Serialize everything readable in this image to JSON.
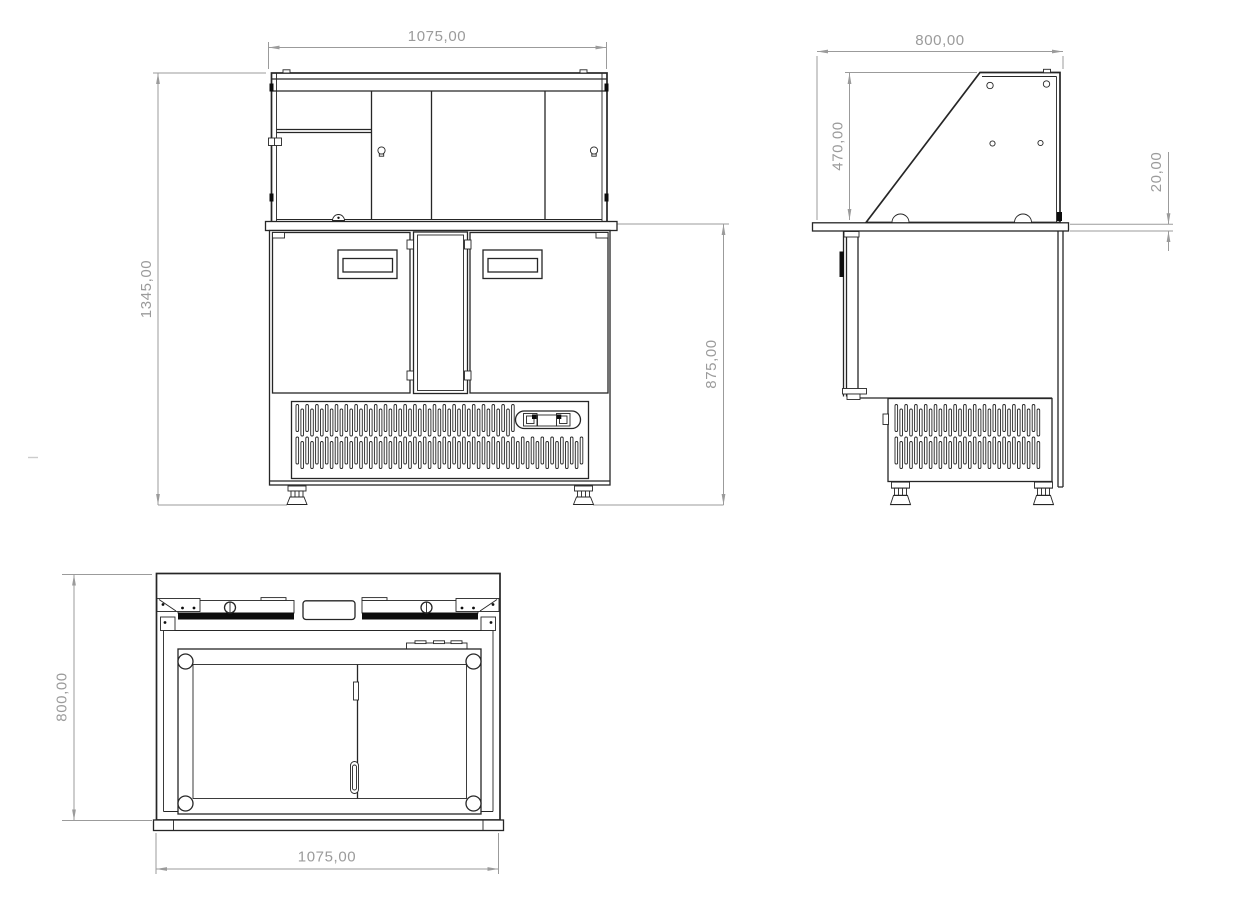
{
  "drawing_title": "refrigerated-saladette-counter-three-view-drawing",
  "views": {
    "front": {
      "label_width_top": "1075,00",
      "label_height_total": "1345,00",
      "label_height_body": "875,00"
    },
    "side": {
      "label_depth_top": "800,00",
      "label_display_height": "470,00",
      "label_counter_thickness": "20,00"
    },
    "plan": {
      "label_depth": "800,00",
      "label_width_bottom": "1075,00"
    }
  },
  "colors": {
    "line": "#262626",
    "dim": "#9b9b9b",
    "dark": "#0d0d0d",
    "background": "#ffffff",
    "faint": "#cccccc"
  }
}
